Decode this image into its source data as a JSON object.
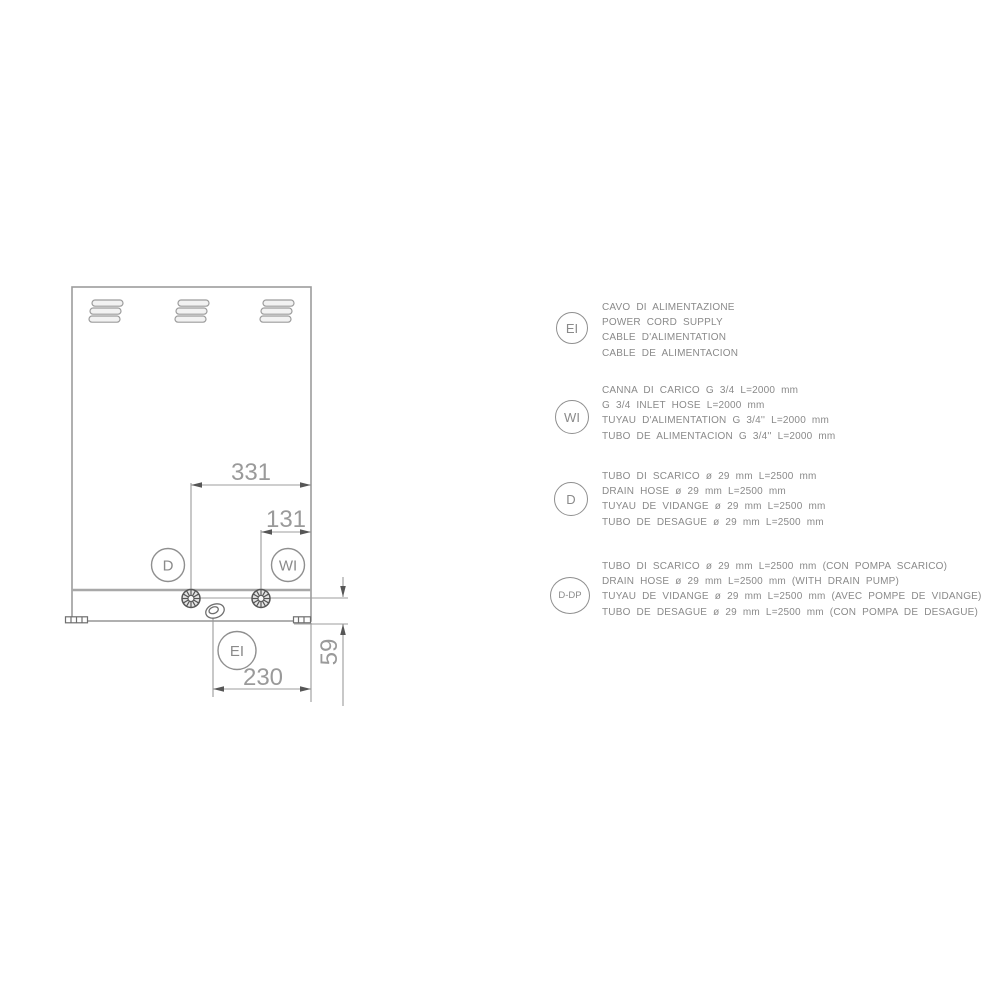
{
  "colors": {
    "background": "#ffffff",
    "line": "#9c9c9c",
    "seam": "#a8a8a8",
    "dark": "#565656",
    "dim_text": "#9a9a9a",
    "legend_text": "#8a8a8a",
    "circle_stroke": "#8f8f8f",
    "vent_fill": "#f2f2f2"
  },
  "drawing": {
    "dims": {
      "d331": "331",
      "d131": "131",
      "d230": "230",
      "d59": "59"
    },
    "callouts": {
      "drain": "D",
      "water": "WI",
      "electric": "EI"
    }
  },
  "legend": {
    "items": [
      {
        "symbol": "EI",
        "lines": [
          "CAVO DI ALIMENTAZIONE",
          "POWER CORD SUPPLY",
          "CABLE D'ALIMENTATION",
          "CABLE DE ALIMENTACION"
        ]
      },
      {
        "symbol": "WI",
        "lines": [
          "CANNA DI CARICO G 3/4 L=2000 mm",
          "G 3/4 INLET HOSE L=2000 mm",
          "TUYAU D'ALIMENTATION G 3/4'' L=2000 mm",
          "TUBO DE ALIMENTACION G 3/4'' L=2000 mm"
        ]
      },
      {
        "symbol": "D",
        "lines": [
          "TUBO DI SCARICO ø 29 mm L=2500 mm",
          "DRAIN HOSE ø 29 mm L=2500 mm",
          "TUYAU DE VIDANGE ø 29 mm L=2500 mm",
          "TUBO DE DESAGUE ø 29 mm L=2500 mm"
        ]
      },
      {
        "symbol": "D-DP",
        "lines": [
          "TUBO DI SCARICO ø 29 mm L=2500 mm (CON POMPA SCARICO)",
          "DRAIN HOSE ø 29 mm L=2500 mm (WITH DRAIN PUMP)",
          "TUYAU DE VIDANGE ø 29 mm L=2500 mm (AVEC POMPE DE VIDANGE)",
          "TUBO DE DESAGUE ø 29 mm L=2500 mm (CON POMPA DE DESAGUE)"
        ]
      }
    ]
  }
}
